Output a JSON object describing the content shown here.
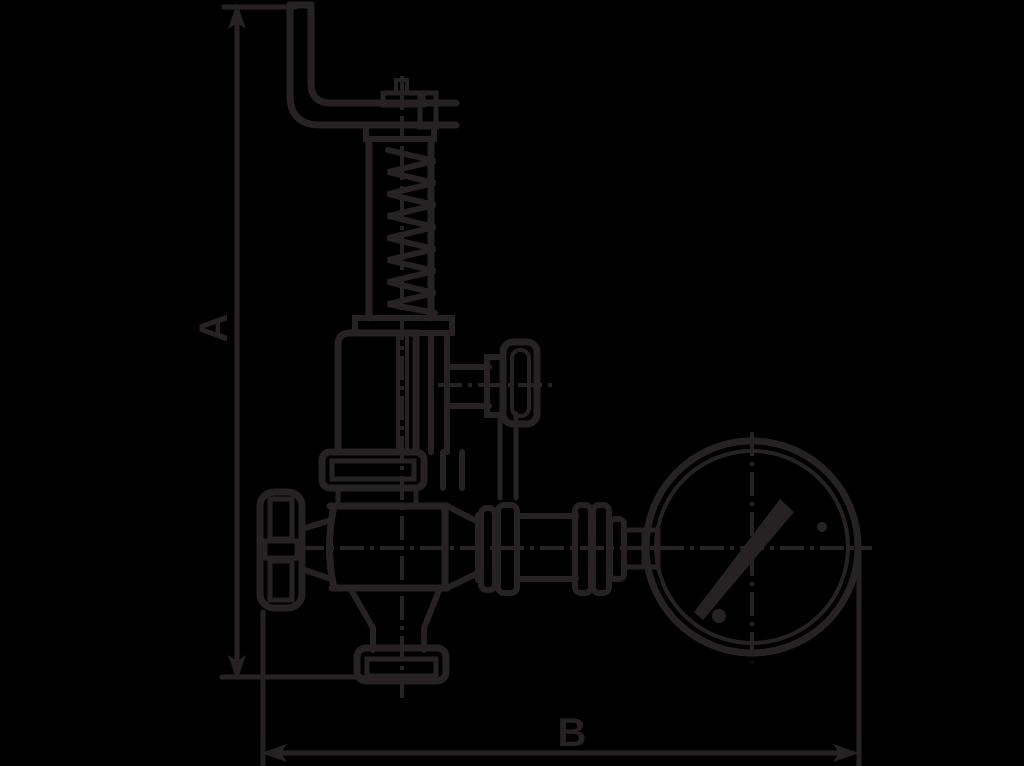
{
  "page": {
    "background_color": "#000000"
  },
  "drawing": {
    "type": "technical line drawing",
    "subject": "spring-loaded safety relief valve with lifting lever, side test valve, handwheel and pressure gauge",
    "line_color": "#262223",
    "dimension_labels": {
      "vertical": "A",
      "horizontal": "B"
    },
    "components": [
      "lifting-lever",
      "spindle-pivot",
      "spring-bonnet",
      "spring-coil",
      "bonnet-housing",
      "test-valve-knob",
      "gland-nut",
      "valve-body",
      "handwheel",
      "outlet-flange",
      "gauge-pipe",
      "pressure-gauge",
      "gauge-needle"
    ]
  }
}
